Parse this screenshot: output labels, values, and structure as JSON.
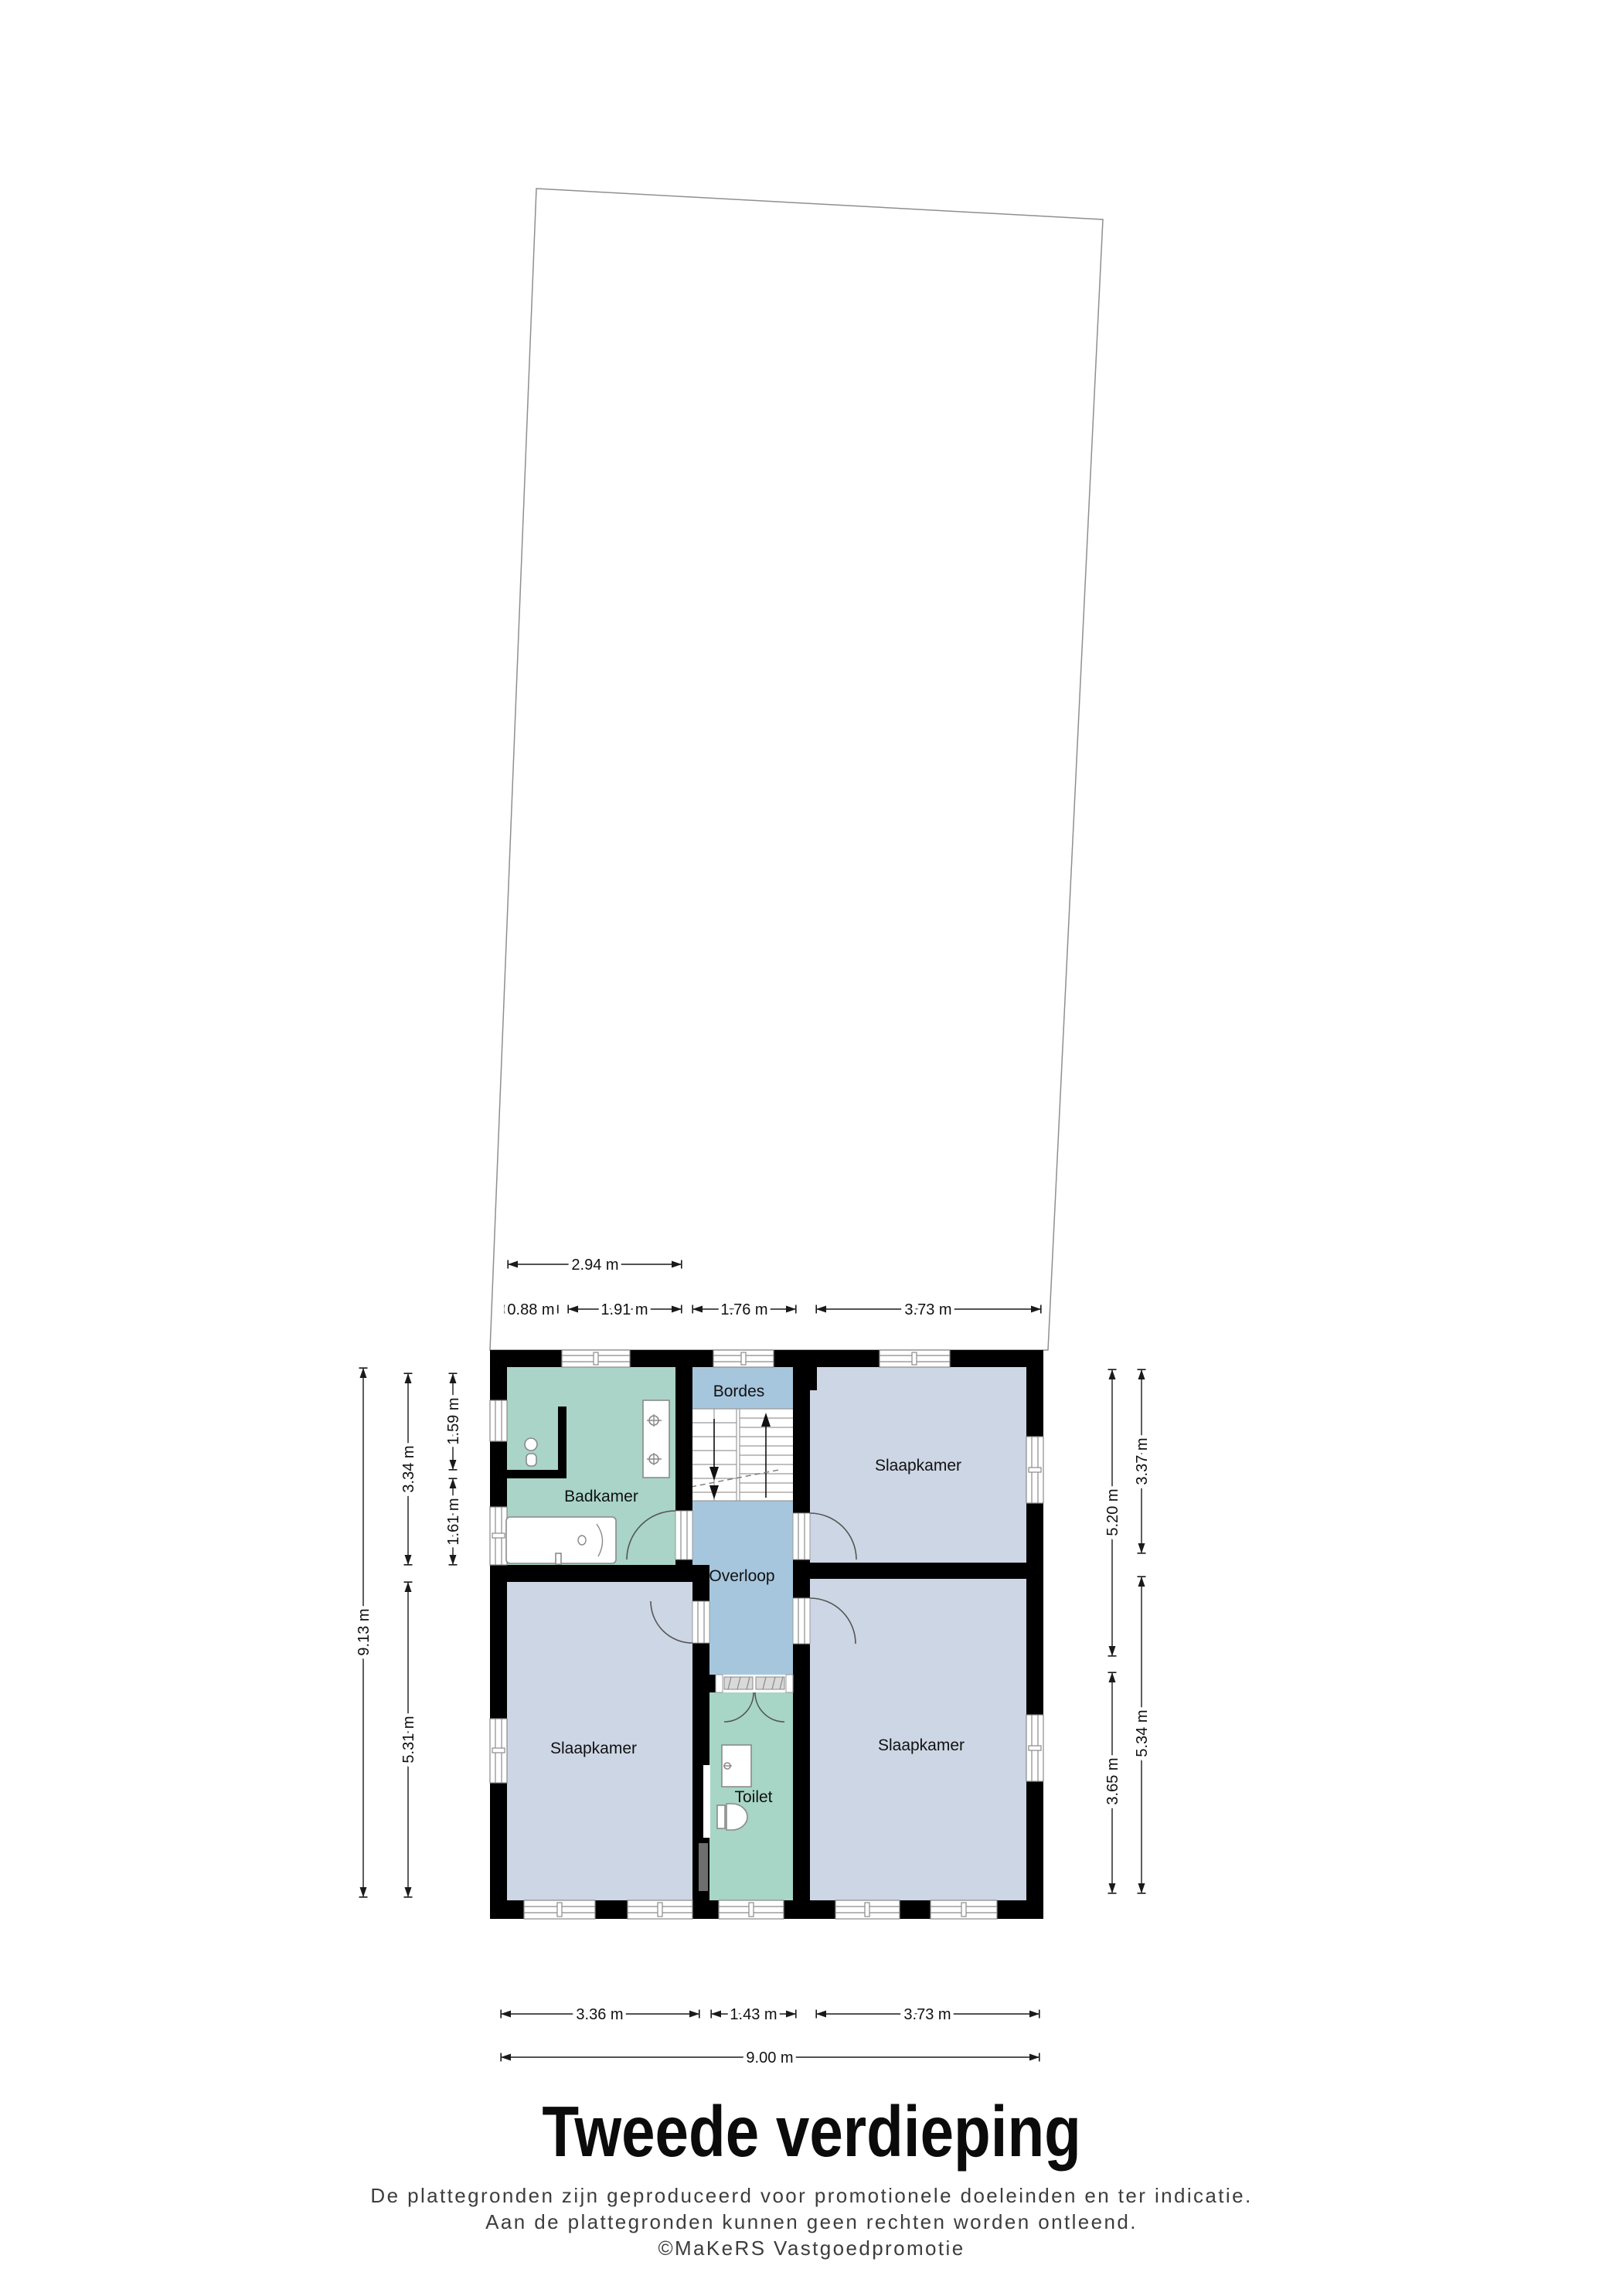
{
  "title": "Tweede verdieping",
  "disclaimer": {
    "line1": "De plattegronden zijn geproduceerd voor promotionele doeleinden en ter indicatie.",
    "line2": "Aan de plattegronden kunnen geen rechten worden ontleend.",
    "line3": "©MaKeRS Vastgoedpromotie"
  },
  "rooms": {
    "bordes": "Bordes",
    "badkamer": "Badkamer",
    "overloop": "Overloop",
    "toilet": "Toilet",
    "slaapkamer_top_right": "Slaapkamer",
    "slaapkamer_bottom_left": "Slaapkamer",
    "slaapkamer_bottom_right": "Slaapkamer"
  },
  "dims": {
    "top_row1": [
      "2.94 m"
    ],
    "top_row2": [
      "0.88 m",
      "1.91 m",
      "1.76 m",
      "3.73 m"
    ],
    "left_col1": [
      "9.13 m"
    ],
    "left_col2": [
      "3.34 m",
      "5.31 m"
    ],
    "left_col3": [
      "1.59 m",
      "1.61 m"
    ],
    "right_col1": [
      "5.20 m",
      "3.65 m"
    ],
    "right_col2": [
      "3.37 m",
      "5.34 m"
    ],
    "bottom_row1": [
      "3.36 m",
      "1.43 m",
      "3.73 m"
    ],
    "bottom_row2": [
      "9.00 m"
    ]
  },
  "colors": {
    "wall": "#000000",
    "badkamer": "#a9d4c7",
    "toilet": "#a7d5c6",
    "corridor": "#a6c6dd",
    "slaapkamer": "#cdd6e4",
    "stairs": "#ffffff",
    "plot_outline": "#8f8f8f",
    "window_line": "#8a8a8a",
    "door_arc": "#555555",
    "shaft": "#6e6e6e",
    "dim_line": "#1a1a1a"
  }
}
